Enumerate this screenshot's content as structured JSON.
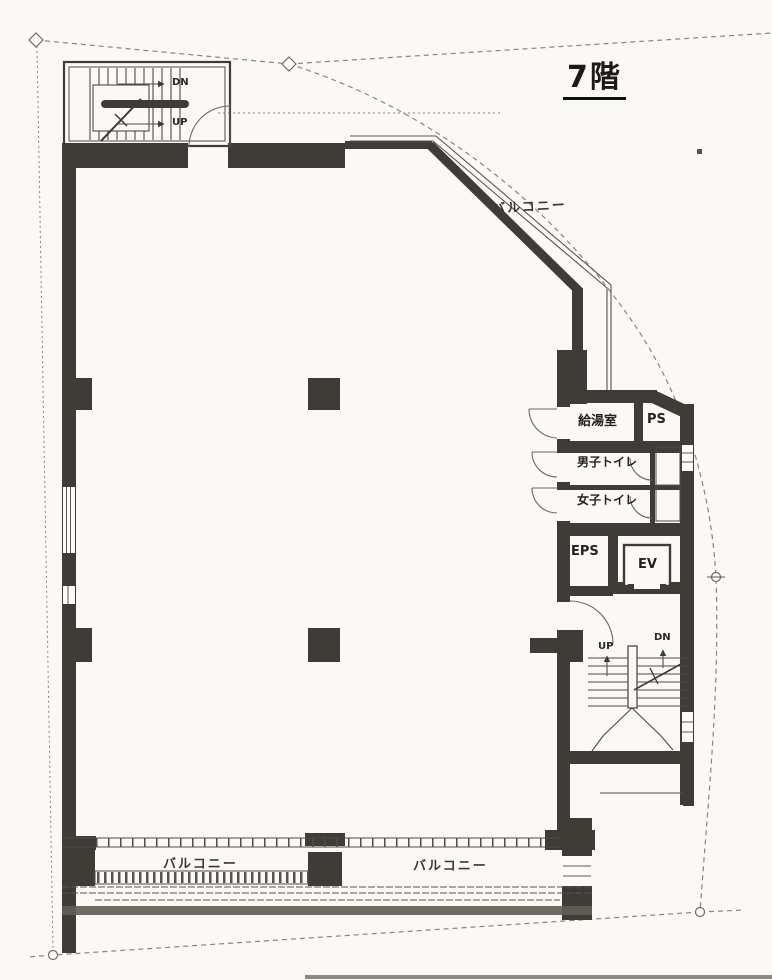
{
  "floor_plan": {
    "title": "7階",
    "rooms": {
      "kitchenette": "給湯室",
      "pipe_shaft": "PS",
      "mens_toilet": "男子トイレ",
      "womens_toilet": "女子トイレ",
      "eps": "EPS",
      "elevator": "EV"
    },
    "stairs_top": {
      "down": "DN",
      "up": "UP"
    },
    "stairs_bottom": {
      "up": "UP",
      "down": "DN"
    },
    "balconies": {
      "top_right": "バルコニー",
      "bottom_left": "バルコニー",
      "bottom_right": "バルコニー"
    }
  },
  "colors": {
    "wall": "#3e3c36",
    "paper": "#faf9f5",
    "boundary": "#87857e"
  }
}
